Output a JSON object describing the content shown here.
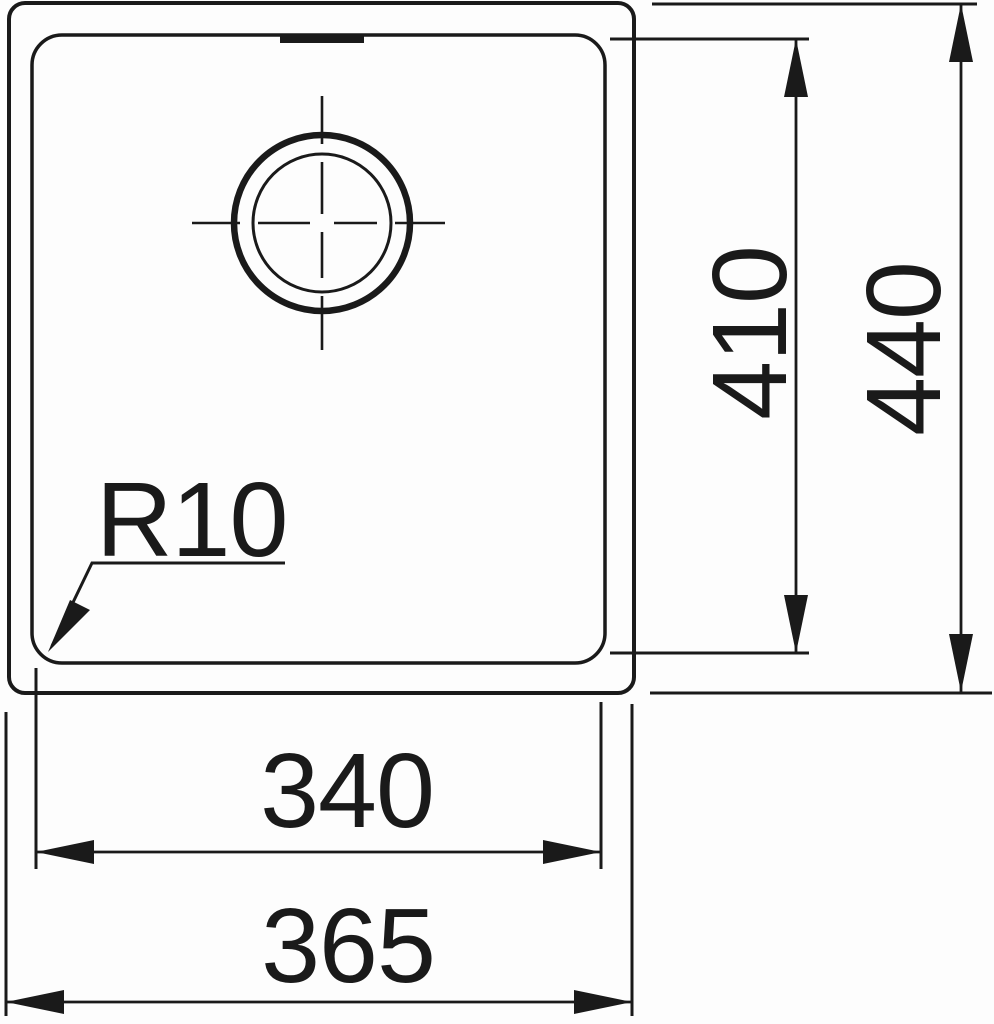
{
  "drawing": {
    "type": "technical-dimension-drawing",
    "subject": "undermount-sink-bowl-top-view",
    "labels": {
      "inner_height": "410",
      "outer_height": "440",
      "inner_width": "340",
      "outer_width": "365",
      "corner_radius": "R10"
    },
    "colors": {
      "line": "#1a1a1a",
      "background": "#fdfdfd"
    }
  }
}
